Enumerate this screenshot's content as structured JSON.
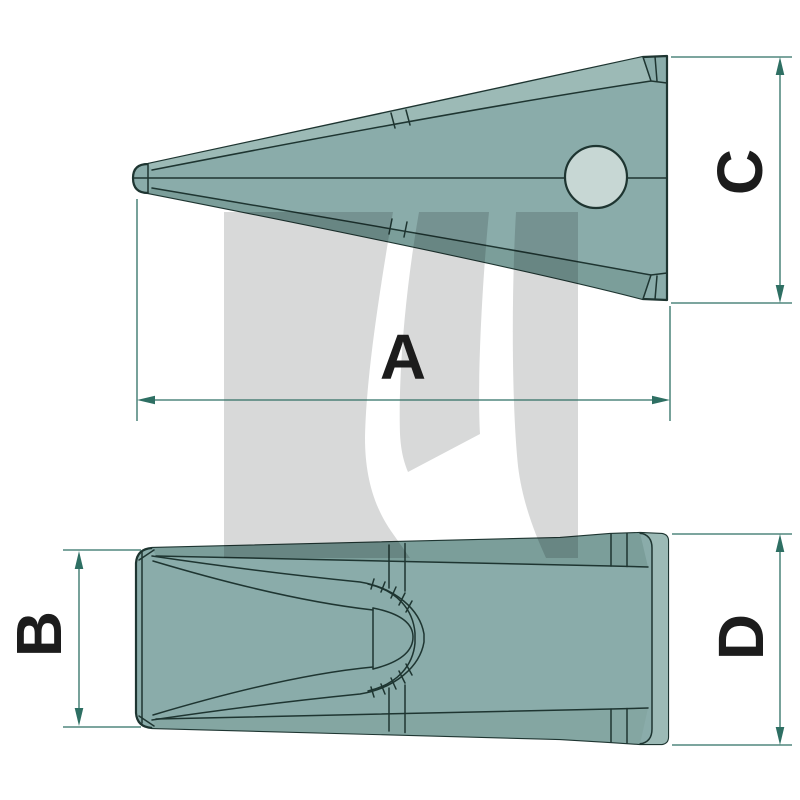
{
  "figure": {
    "description": "Two-view technical line drawing of an excavator bucket tooth",
    "views": [
      "side profile with pin hole",
      "plan view with socket"
    ]
  },
  "labels": {
    "a": "A",
    "b": "B",
    "c": "C",
    "d": "D"
  },
  "colors": {
    "body": "#8aacaa",
    "band-light": "#9cbab6",
    "band-dark": "#7b9e9a",
    "band-mid": "#84a6a2",
    "hole": "#c7d7d4",
    "line": "#1e3531",
    "dim": "#2e6f63",
    "label": "#1c1c1c",
    "watermark": "#d8d9d9"
  }
}
